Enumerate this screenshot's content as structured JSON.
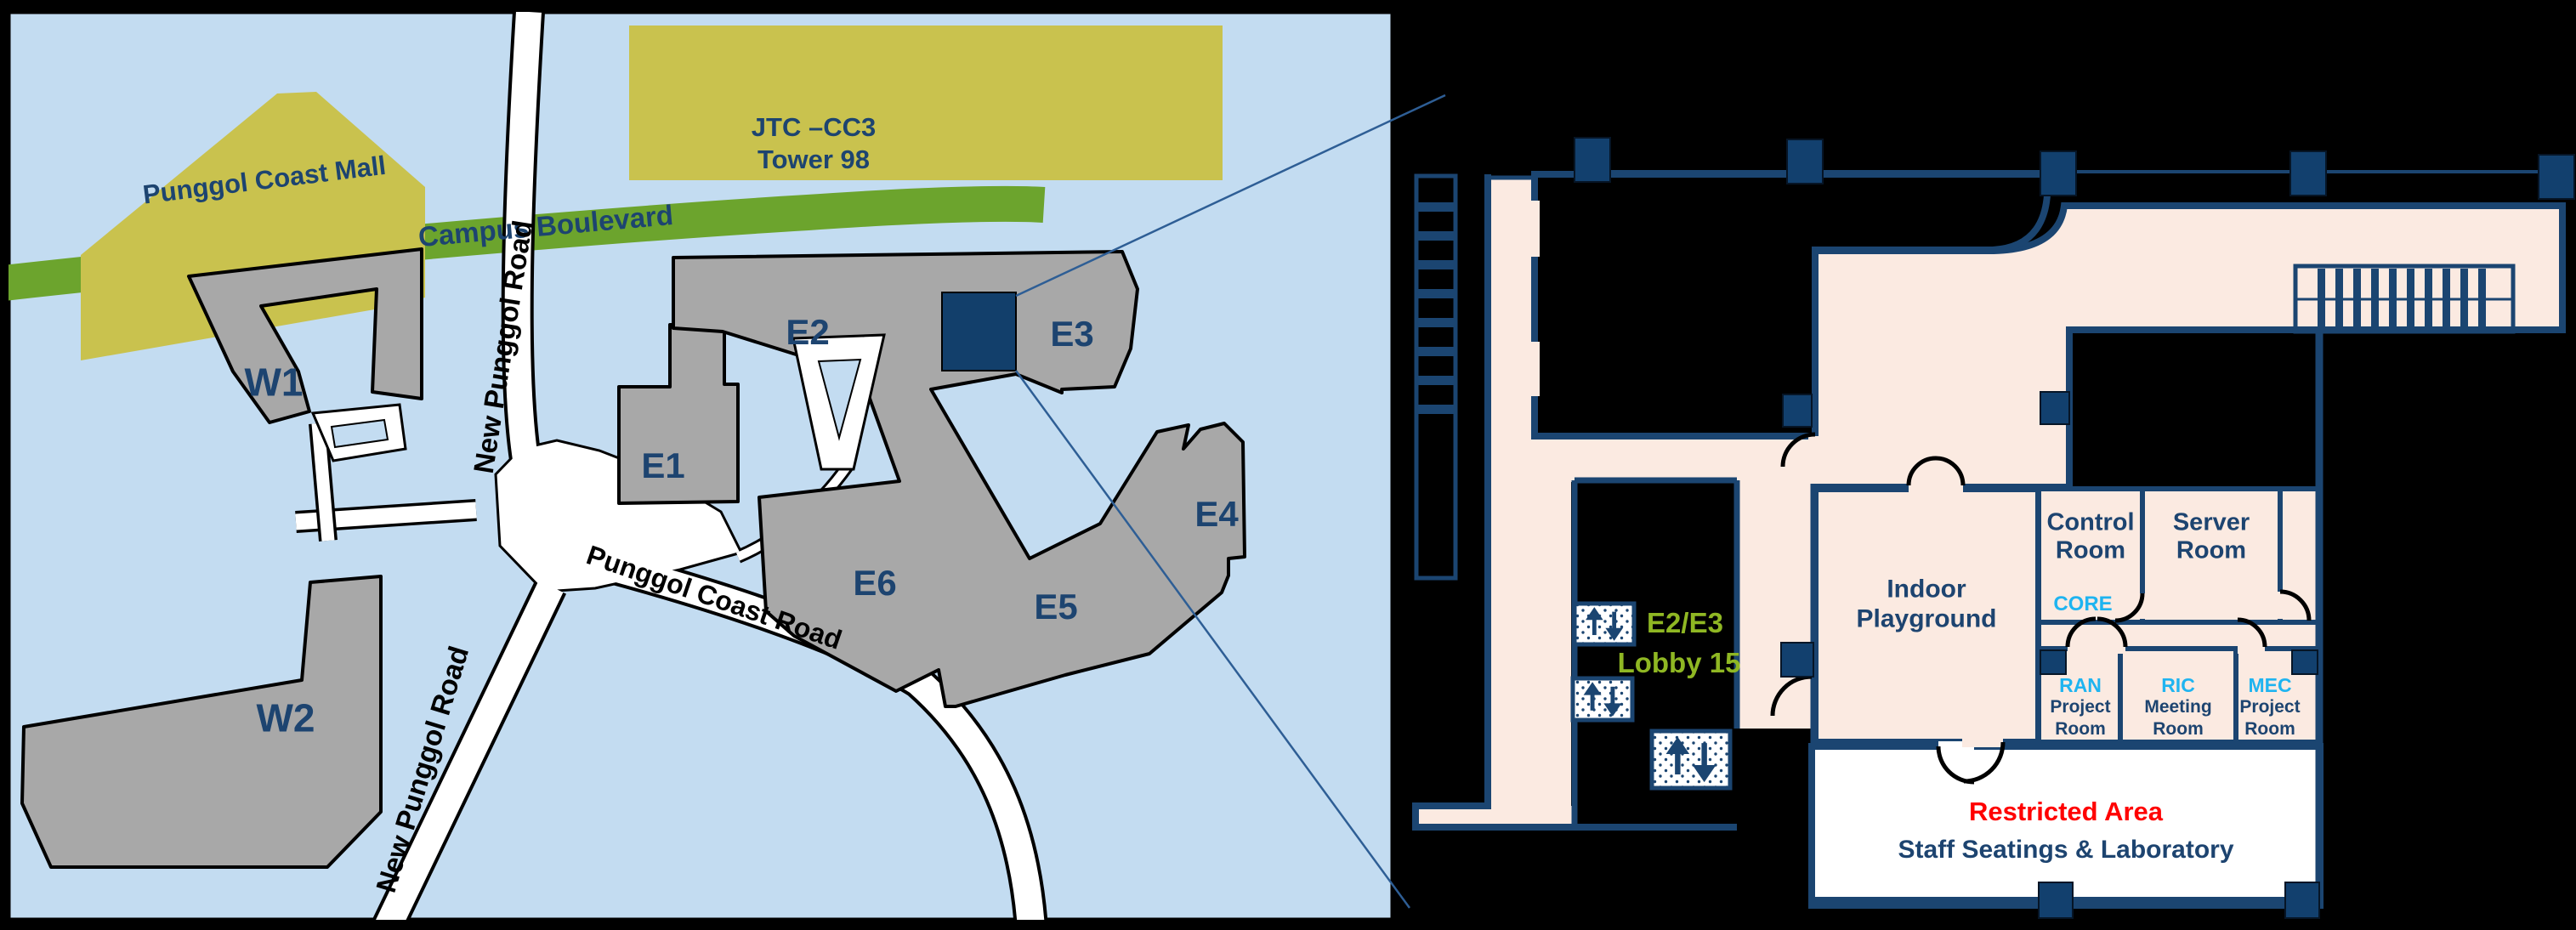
{
  "map": {
    "landmarks": {
      "mall": "Punggol Coast Mall",
      "jtc_line1": "JTC –CC3",
      "jtc_line2": "Tower 98"
    },
    "buildings": {
      "w1": "W1",
      "w2": "W2",
      "e1": "E1",
      "e2": "E2",
      "e3": "E3",
      "e4": "E4",
      "e5": "E5",
      "e6": "E6"
    },
    "roads": {
      "campus_boulevard": "Campus Boulevard",
      "new_punggol_upper": "New Punggol Road",
      "new_punggol_lower": "New Punggol Road",
      "punggol_coast": "Punggol Coast Road"
    }
  },
  "floor_plan": {
    "rooms": {
      "indoor_playground": "Indoor Playground",
      "control_room": "Control Room",
      "core": "CORE",
      "server_room": "Server Room",
      "ran_label": "RAN",
      "ran_line2": "Project",
      "ran_line3": "Room",
      "ric_label": "RIC",
      "ric_line2": "Meeting",
      "ric_line3": "Room",
      "mec_label": "MEC",
      "mec_line2": "Project",
      "mec_line3": "Room",
      "restricted_line1": "Restricted Area",
      "restricted_line2": "Staff Seatings & Laboratory",
      "lobby_line1": "E2/E3",
      "lobby_line2": "Lobby 15"
    }
  },
  "colors": {
    "map_bg": "#C3DCF1",
    "building_gray": "#A8A8A8",
    "landmark_yellow": "#C9C24E",
    "road_green": "#6CA42D",
    "navy_text": "#1D4470",
    "wall_navy": "#1B4571",
    "floor_pink": "#FBEAE1",
    "cyan_label": "#1FB4F0",
    "lobby_green": "#8FB723",
    "restricted_red": "#FF0000",
    "highlight_square": "#123F6B"
  }
}
